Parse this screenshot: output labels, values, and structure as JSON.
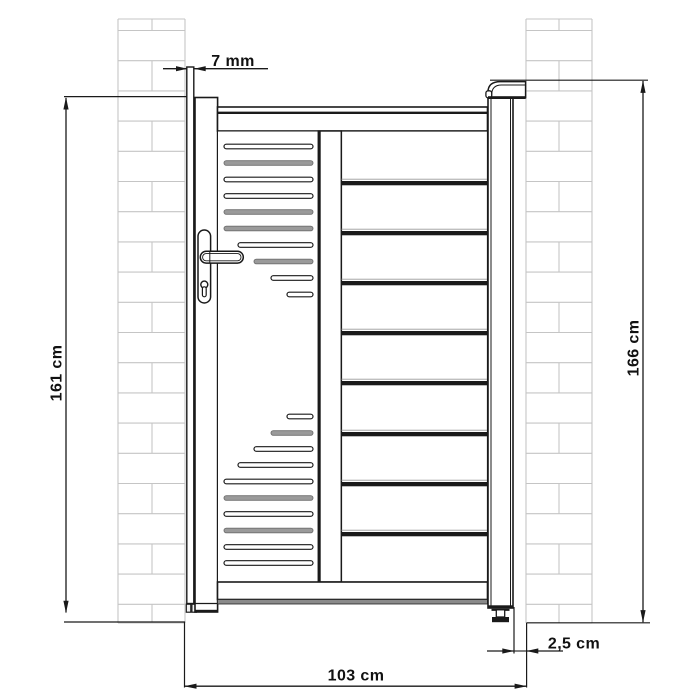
{
  "drawing_title": "gate-with-pillars-dimension-drawing",
  "dimensions": {
    "frame_gap": {
      "label": "7 mm"
    },
    "gate_height": {
      "label": "161 cm"
    },
    "post_height": {
      "label": "166 cm"
    },
    "total_width": {
      "label": "103 cm"
    },
    "wall_clearance": {
      "label": "2,5 cm"
    }
  },
  "colors": {
    "line": "#1a1a1a",
    "brick": "#c5c5c5",
    "shade": "#8a8a8a",
    "slat_gray": "#9a9a9a",
    "slat_gray_stroke": "#6e6e6e",
    "background": "#ffffff"
  },
  "drawing": {
    "pillars": {
      "top": 19,
      "bottom": 623,
      "first_course": 30.5,
      "course_step": 30.2,
      "left": {
        "x": 118,
        "w": 67,
        "joint_x": 152
      },
      "right": {
        "x": 526,
        "w": 66,
        "joint_x": 559
      }
    },
    "slat_panel": {
      "x2": 313,
      "height": 4.6,
      "slats": [
        {
          "y": 146.5,
          "x1": 224,
          "tone": "line"
        },
        {
          "y": 163.0,
          "x1": 224,
          "tone": "gray"
        },
        {
          "y": 179.5,
          "x1": 224,
          "tone": "line"
        },
        {
          "y": 196.0,
          "x1": 224,
          "tone": "line"
        },
        {
          "y": 212.0,
          "x1": 224,
          "tone": "gray"
        },
        {
          "y": 228.5,
          "x1": 224,
          "tone": "gray"
        },
        {
          "y": 245.0,
          "x1": 238,
          "tone": "line"
        },
        {
          "y": 261.5,
          "x1": 254,
          "tone": "gray"
        },
        {
          "y": 278.0,
          "x1": 271,
          "tone": "line"
        },
        {
          "y": 294.5,
          "x1": 287,
          "tone": "line"
        },
        {
          "y": 416.5,
          "x1": 287,
          "tone": "line"
        },
        {
          "y": 433.0,
          "x1": 271,
          "tone": "gray"
        },
        {
          "y": 449.0,
          "x1": 254,
          "tone": "line"
        },
        {
          "y": 465.0,
          "x1": 238,
          "tone": "line"
        },
        {
          "y": 481.5,
          "x1": 224,
          "tone": "line"
        },
        {
          "y": 498.0,
          "x1": 224,
          "tone": "gray"
        },
        {
          "y": 514.0,
          "x1": 224,
          "tone": "line"
        },
        {
          "y": 530.5,
          "x1": 224,
          "tone": "gray"
        },
        {
          "y": 547.0,
          "x1": 224,
          "tone": "line"
        },
        {
          "y": 563.0,
          "x1": 224,
          "tone": "line"
        }
      ]
    },
    "board_panel": {
      "x": 341.5,
      "w": 145.5,
      "divider_h": 4.3,
      "divider_ys": [
        181,
        231,
        281,
        331,
        381,
        432,
        482,
        532
      ]
    }
  }
}
